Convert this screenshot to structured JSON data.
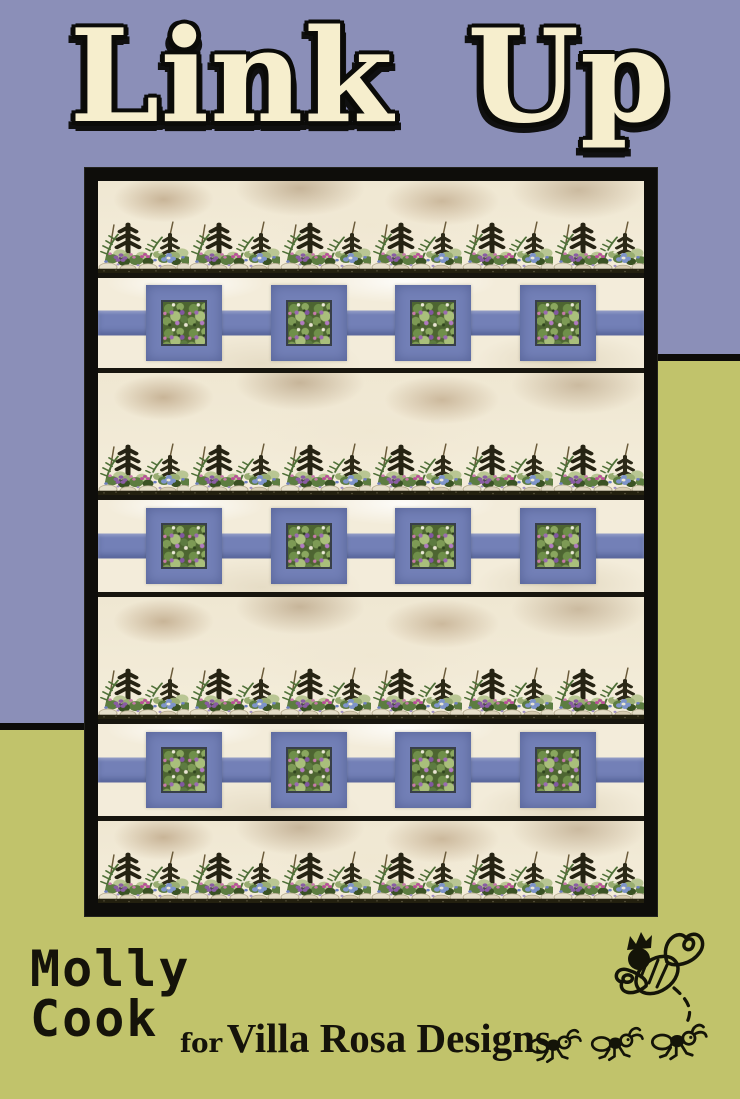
{
  "page": {
    "title": "Link Up",
    "byline": {
      "author_line1": "Molly",
      "author_line2": "Cook",
      "connector": "for",
      "brand": "Villa Rosa Designs"
    }
  },
  "colors": {
    "background_purple": "#8b8fb8",
    "background_green": "#c1c36b",
    "link_blue": "#7380b7",
    "quilt_cream": "#f3ecda",
    "frame_black": "#0e0d0a",
    "title_cream": "#f6eecd",
    "text_black": "#15130a"
  },
  "icons": {
    "bee": "crowned-bee-doodle",
    "ants": "three-marching-ants-doodle"
  },
  "quilt": {
    "description": "Photo of a quilt with alternating floral garden border strips and chain-link rows of periwinkle squares with floral centers on a cream background, framed in black",
    "rows": [
      {
        "type": "floral-strip"
      },
      {
        "type": "link-row",
        "squares": 4
      },
      {
        "type": "floral-strip"
      },
      {
        "type": "link-row",
        "squares": 4
      },
      {
        "type": "floral-strip"
      },
      {
        "type": "link-row",
        "squares": 4
      },
      {
        "type": "floral-strip"
      }
    ]
  }
}
